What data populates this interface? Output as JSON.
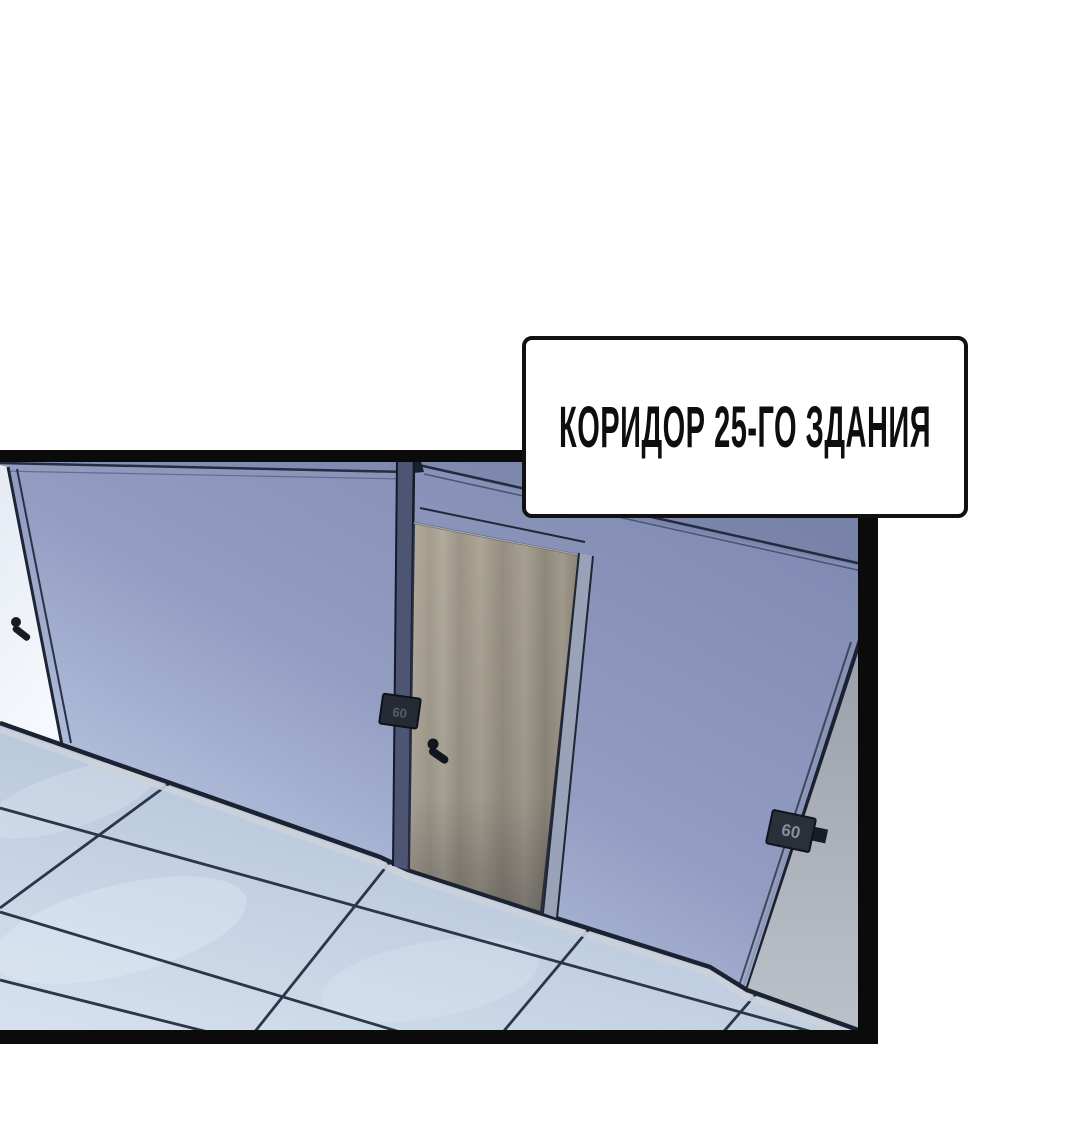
{
  "comic": {
    "caption": {
      "text": "КОРИДОР 25-ГО ЗДАНИЯ",
      "background": "#ffffff",
      "border_color": "#111111",
      "text_color": "#0e0e0e"
    },
    "panel": {
      "border_color": "#0b0b0b",
      "wall_color_top": "#7f88b0",
      "wall_color_bottom": "#d2e0f0",
      "floor_tile_color": "#bfcde0",
      "grout_color": "#2b3648",
      "center_door_color": "#a8a193",
      "left_door_color": "#edf1f8",
      "gray_wall_color": "#a6acb6",
      "plaques": [
        {
          "label": "60"
        },
        {
          "label": "60"
        }
      ]
    }
  }
}
